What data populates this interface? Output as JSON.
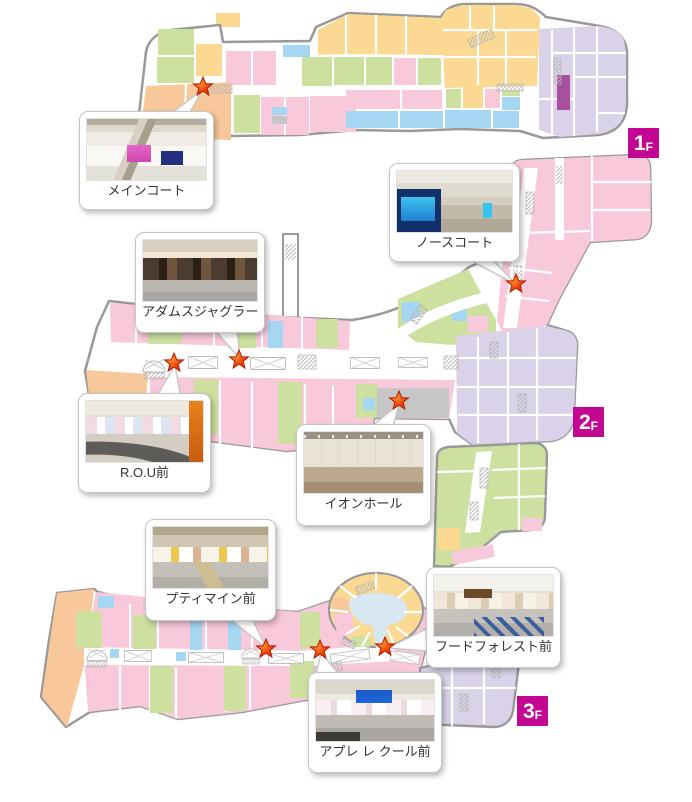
{
  "floors": [
    {
      "num": "1",
      "suffix": "F"
    },
    {
      "num": "2",
      "suffix": "F"
    },
    {
      "num": "3",
      "suffix": "F"
    }
  ],
  "callouts": [
    {
      "id": "main-court",
      "label": "メインコート",
      "floor": "1F"
    },
    {
      "id": "north-court",
      "label": "ノースコート",
      "floor": "2F"
    },
    {
      "id": "adams-juggler",
      "label": "アダムスジャグラー前",
      "floor": "2F"
    },
    {
      "id": "rou",
      "label": "R.O.U前",
      "floor": "2F"
    },
    {
      "id": "aeon-hall",
      "label": "イオンホール",
      "floor": "2F"
    },
    {
      "id": "petit-main",
      "label": "プティマイン前",
      "floor": "3F"
    },
    {
      "id": "food-forest",
      "label": "フードフォレスト前",
      "floor": "3F"
    },
    {
      "id": "apres-les-cours",
      "label": "アプレ レ クール前",
      "floor": "3F"
    }
  ],
  "icons": {
    "location_marker": "red-star",
    "escalator": "arched-circle-with-cross",
    "moving_walkway": "crossed-rectangle"
  },
  "palette": {
    "shop_pink": "#f8c9da",
    "shop_green": "#cde0a0",
    "shop_yellow": "#fcd992",
    "shop_orange": "#f8c89b",
    "shop_blue": "#a5d6f2",
    "dept_lavender": "#dad2e8",
    "accent_magenta": "#a8509c",
    "hall_gray": "#c6c6c6",
    "badge_magenta": "#c40792",
    "star_red": "#e8380d",
    "outline_gray": "#999999"
  }
}
